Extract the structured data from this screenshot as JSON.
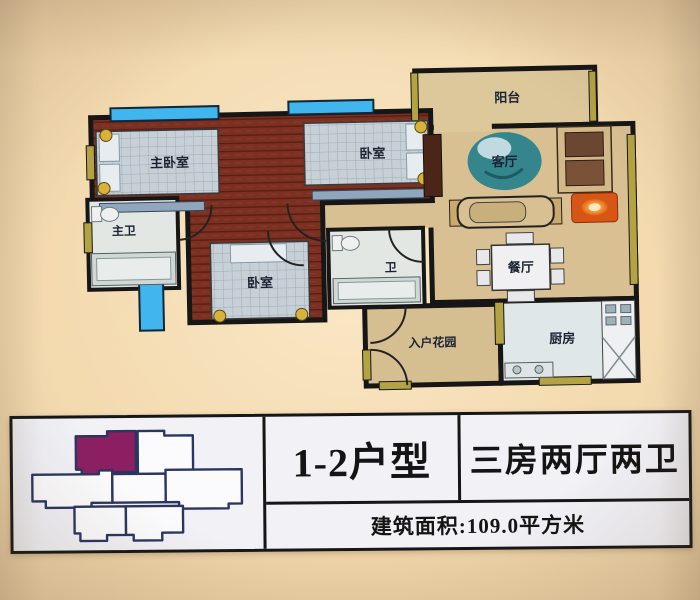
{
  "floorplan": {
    "rooms": [
      {
        "id": "balcony",
        "label": "阳台"
      },
      {
        "id": "living-room",
        "label": "客厅"
      },
      {
        "id": "dining-room",
        "label": "餐厅"
      },
      {
        "id": "kitchen",
        "label": "厨房"
      },
      {
        "id": "entry-garden",
        "label": "入户花园"
      },
      {
        "id": "master-bedroom",
        "label": "主卧室"
      },
      {
        "id": "bedroom-top",
        "label": "卧室"
      },
      {
        "id": "bedroom-bottom",
        "label": "卧室"
      },
      {
        "id": "master-bath",
        "label": "主卫"
      },
      {
        "id": "bath",
        "label": "卫"
      }
    ],
    "colors": {
      "wood_floor": "#7c3022",
      "tan_floor": "#d8c092",
      "wall": "#161616",
      "window_blue": "#41b6ee",
      "accent_olive": "#b3a342",
      "bed_quilt": "#c7d0d6",
      "gold_dot": "#d9b23a",
      "lamp_orange": "#d85615",
      "plant_teal": "#35858d"
    }
  },
  "building_key_plan": {
    "highlight_color": "#8b1f62",
    "outline_color": "#2a3560"
  },
  "info_panel": {
    "unit_type": "1-2户型",
    "layout_type": "三房两厅两卫",
    "area_label": "建筑面积:109.0平方米"
  }
}
